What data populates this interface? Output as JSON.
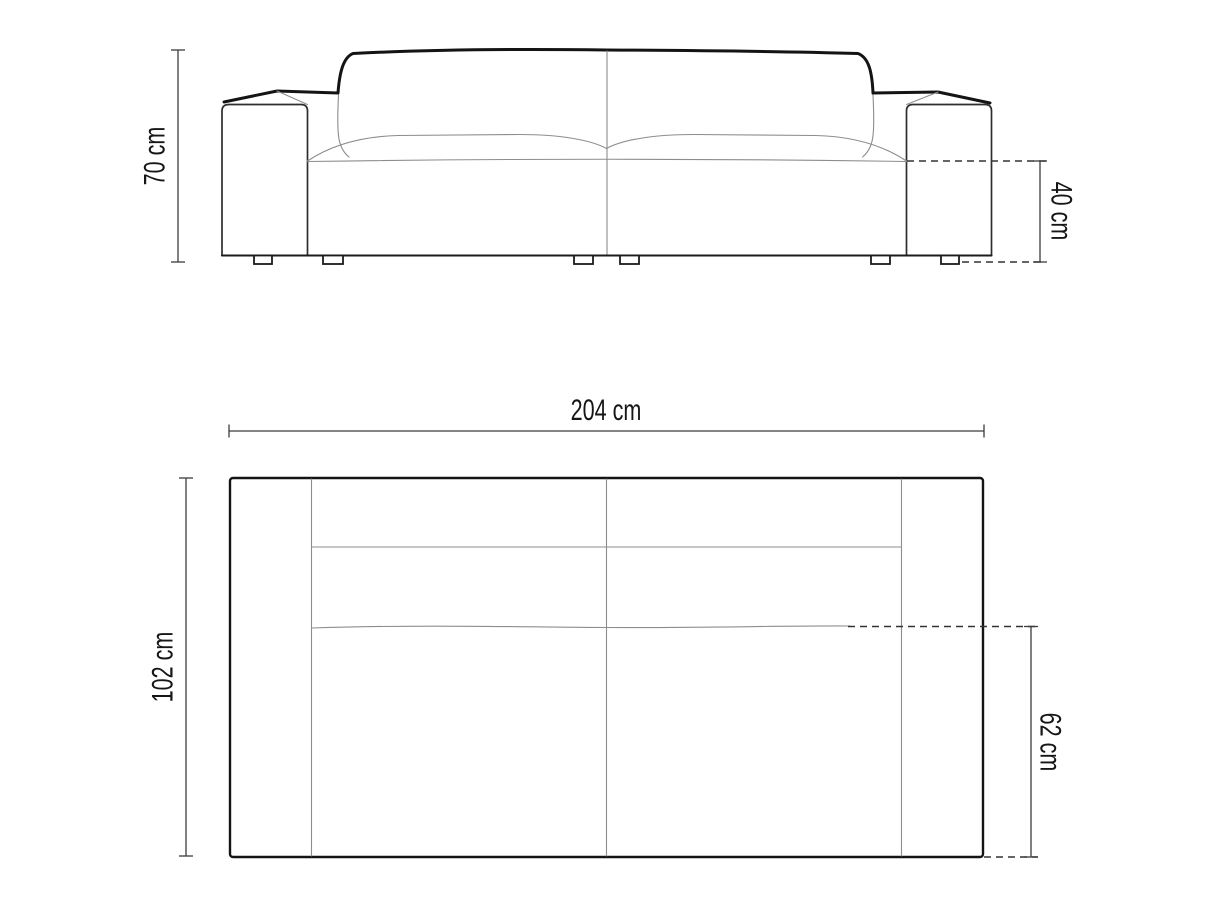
{
  "diagram": {
    "kind": "sofa-dimension-technical-drawing",
    "views": {
      "front": {
        "dimensions": {
          "overall_height": "70 cm",
          "seat_height": "40 cm"
        }
      },
      "top": {
        "dimensions": {
          "overall_width": "204 cm",
          "overall_depth": "102 cm",
          "seat_depth": "62 cm"
        }
      }
    },
    "colors": {
      "background": "#ffffff",
      "outline": "#141414",
      "detail_line": "#8d8d8d",
      "dimension_line": "#3c3c3c",
      "dashed_line": "#333333",
      "label_text": "#161616"
    }
  }
}
